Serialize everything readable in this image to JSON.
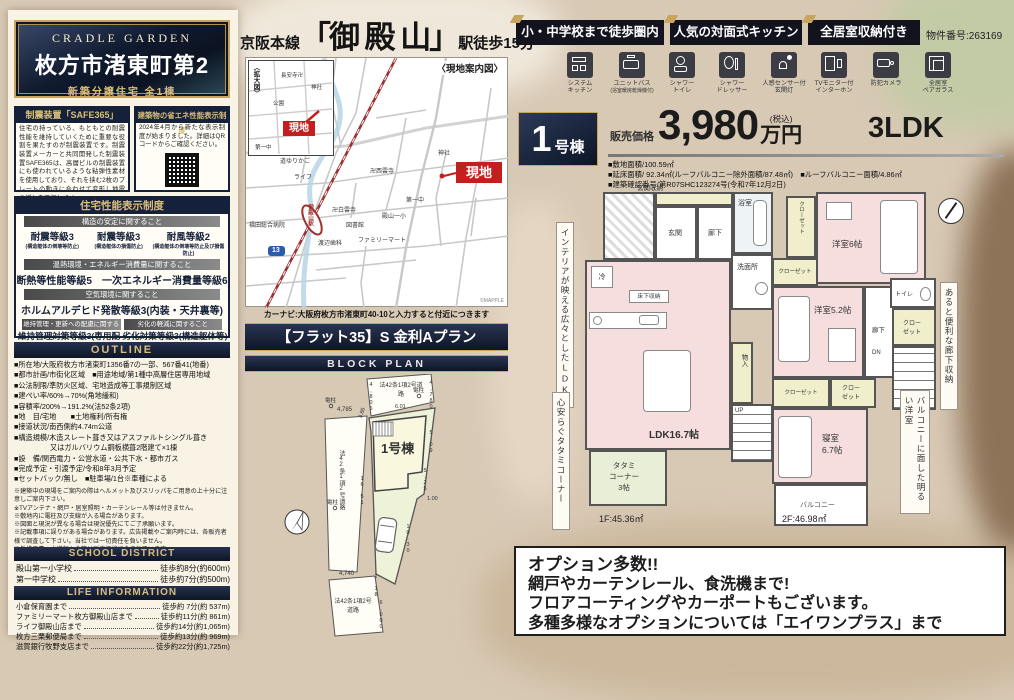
{
  "colors": {
    "navy": "#15213a",
    "gold": "#c8a55f",
    "red": "#c31f1f",
    "room_pink": "#f6dede",
    "tatami_green": "#e9efd6",
    "closet_cream": "#f1eecb"
  },
  "left": {
    "brand": "CRADLE GARDEN",
    "title": "枚方市渚東町第2",
    "subtitle": "新築分譲住宅 全1棟",
    "seismic": {
      "h": "制震装置「SAFE365」",
      "b": "住宅の持っている、もともとの耐震性能を維持していくために重要な役割を果たすのが制震装置です。制震装置メーカーと共同開発した制震装置SAFE365は、高層ビルの制震装置にも使われているような粘弾性素材を使用しており、それを挟む2枚のプレートの動きに合わせて変形し地震の揺れを吸収します。"
    },
    "energy": {
      "h": "建築物の省エネ性能表示制度",
      "b": "2024年4月から新たな表示制度が始まりました。詳細はQRコードからご確認ください。"
    },
    "perf": {
      "h": "住宅性能表示制度",
      "bar1": "構造の安定に関すること",
      "grades": [
        {
          "g": "耐震等級3",
          "n": "(構造躯体の倒壊等防止)"
        },
        {
          "g": "耐震等級3",
          "n": "(構造躯体の損傷防止)"
        },
        {
          "g": "耐風等級2",
          "n": "(構造躯体の倒壊等防止及び損傷防止)"
        }
      ],
      "bar2": "温熱環境・エネルギー消費量に関すること",
      "row2": "断熱等性能等級5　一次エネルギー消費量等級6",
      "bar3": "空気環境に関すること",
      "row3": "ホルムアルデヒド発散等級3(内装・天井裏等)",
      "bar4a": "維持管理・更新への配慮に関すること",
      "bar4b": "劣化の軽減に関すること",
      "row4a": "維持管理対策等級3(専用配管)",
      "row4b": "劣化対策等級3(構造躯体等)"
    },
    "outline": {
      "h": "OUTLINE",
      "items": [
        "■所在地/大阪府枚方市渚東町1356番7の一部、567番41(地番)",
        "■都市計画/市街化区域　■用途地域/第1種中高層住居専用地域",
        "■公法制限/準防火区域、宅地造成等工事規制区域",
        "■建ぺい率/60%→70%(角地緩和)",
        "■容積率/200%→191.2%(法52条2項)",
        "■地　目/宅地　　■土地権利/所有権",
        "■接道状況/南西側約4.74m公道",
        "■構造規模/木造スレート葺き又はアスファルトシングル葺き",
        "　　　　　又はガルバリウム鋼板横葺2階建て×1棟",
        "■設　備/関西電力・公営水道・公共下水・都市ガス",
        "■完成予定・引渡予定/令和8年3月予定",
        "■セットバック/無し　■駐車場/1台※車種による"
      ],
      "notes": [
        "※建築中の現場をご案内の際はヘルメット及びスリッパをご用意の上十分に注意しご案内下さい。",
        "※TVアンテナ・網戸・居室照明・カーテンレール等は付きません。",
        "※敷地内に電柱及び支線が入る場合があります。",
        "※図面と現況が異なる場合は現況優先にてご了承願います。",
        "※記載事項に誤りがある場合があります。広告掲載やご案内時には、各販売者様で調査して下さい。当社では一切責任を負いません。",
        "※外構工事、水道加入金等は販売価格に含まれています。"
      ]
    },
    "school": {
      "h": "SCHOOL DISTRICT",
      "rows": [
        {
          "n": "殿山第一小学校",
          "v": "徒歩約8分(約600m)"
        },
        {
          "n": "第一中学校",
          "v": "徒歩約7分(約500m)"
        }
      ]
    },
    "life": {
      "h": "LIFE INFORMATION",
      "rows": [
        {
          "n": "小倉保育園まで",
          "v": "徒歩約 7分(約 537m)"
        },
        {
          "n": "ファミリーマート枚方御殿山店まで",
          "v": "徒歩約11分(約 861m)"
        },
        {
          "n": "ライフ御殿山店まで",
          "v": "徒歩約14分(約1,065m)"
        },
        {
          "n": "枚方三栗郵便局まで",
          "v": "徒歩約13分(約 969m)"
        },
        {
          "n": "滋賀銀行牧野支店まで",
          "v": "徒歩約22分(約1,725m)"
        }
      ]
    }
  },
  "mid": {
    "line_prefix": "京阪本線",
    "station": "「御 殿 山」",
    "line_suffix": "駅徒歩15分",
    "map": {
      "caption": "〈現地案内図〉",
      "inset_caption": "〈拡大図〉",
      "site": "現地",
      "station_name": "御殿山駅",
      "route_no": "13",
      "credit": "©MAPPLE",
      "labels": [
        "渚西中",
        "コーナン",
        "道ゆりかご",
        "ライフ",
        "卍西雲寺",
        "神社",
        "第一中",
        "卍白雲寺",
        "殿山一小",
        "図書館",
        "ファミリーマート",
        "渡辺歯科",
        "福田総合病院"
      ],
      "inset_labels": [
        "長安寺卍",
        "神社",
        "公園",
        "第一中"
      ]
    },
    "navi": "カーナビ:大阪府枚方市渚東町40-10と入力すると付近につきます",
    "flat35": "【フラット35】S 金利Aプラン",
    "block_header": "BLOCK PLAN",
    "block": {
      "name": "1号棟",
      "road": "法42条1項2号道路",
      "pole": "電柱",
      "dims": [
        "4,785",
        "3.86",
        "4,805",
        "4,780",
        "6.01",
        "5.09",
        "5.25",
        "1.00",
        "10.30",
        "16.51",
        "4,740",
        "2.18",
        "6,000"
      ]
    }
  },
  "right": {
    "badges": [
      "小・中学校まで徒歩圏内",
      "人気の対面式キッチン",
      "全居室収納付き"
    ],
    "property_no": "物件番号:263169",
    "features": [
      {
        "l1": "システム",
        "l2": "キッチン"
      },
      {
        "l1": "ユニットバス",
        "l2": "(浴室暖房乾燥機付)"
      },
      {
        "l1": "シャワー",
        "l2": "トイレ"
      },
      {
        "l1": "シャワー",
        "l2": "ドレッサー"
      },
      {
        "l1": "人感センサー付",
        "l2": "玄関灯"
      },
      {
        "l1": "TVモニター付",
        "l2": "インターホン"
      },
      {
        "l1": "防犯カメラ",
        "l2": ""
      },
      {
        "l1": "全居室",
        "l2": "ペアガラス"
      }
    ],
    "price": {
      "num": "1",
      "suffix": "号棟",
      "label": "販売価格",
      "amount": "3,980",
      "tax": "(税込)",
      "unit": "万円",
      "layout": "3LDK"
    },
    "specs": [
      "■敷地面積/100.59㎡",
      "■延床面積/ 92.34㎡(ルーフバルコニー除外面積/87.48㎡)　■ルーフバルコニー面積/4.86㎡",
      "■建築確認番号/第R07SHC123274号(令和7年12月2日)"
    ],
    "plan1f": {
      "labels": [
        "玄関収納",
        "玄関",
        "廊下",
        "浴室",
        "洗面所",
        "冷",
        "床下収納",
        "LDK16.7帖",
        "物入",
        "UP",
        "タタミ\nコーナー\n3帖",
        "1F:45.36㎡"
      ]
    },
    "plan2f": {
      "labels": [
        "クローゼット",
        "洋室6帖",
        "クローゼット",
        "洋室5.2帖",
        "廊下",
        "トイレ",
        "クロー\nゼット",
        "DN",
        "クローゼット",
        "クロー\nゼット",
        "寝室\n6.7帖",
        "バルコニー",
        "2F:46.98㎡"
      ]
    },
    "notes": [
      "インテリアが映える広々としたLDK",
      "心安らぐタタミコーナー",
      "あると便利な廊下収納",
      "バルコニーに面した明るい洋室"
    ],
    "options": [
      "オプション多数!!",
      "網戸やカーテンレール、食洗機まで!",
      "フロアコーティングやカーポートもございます。",
      "多種多様なオプションについては「エイワンプラス」まで"
    ]
  }
}
